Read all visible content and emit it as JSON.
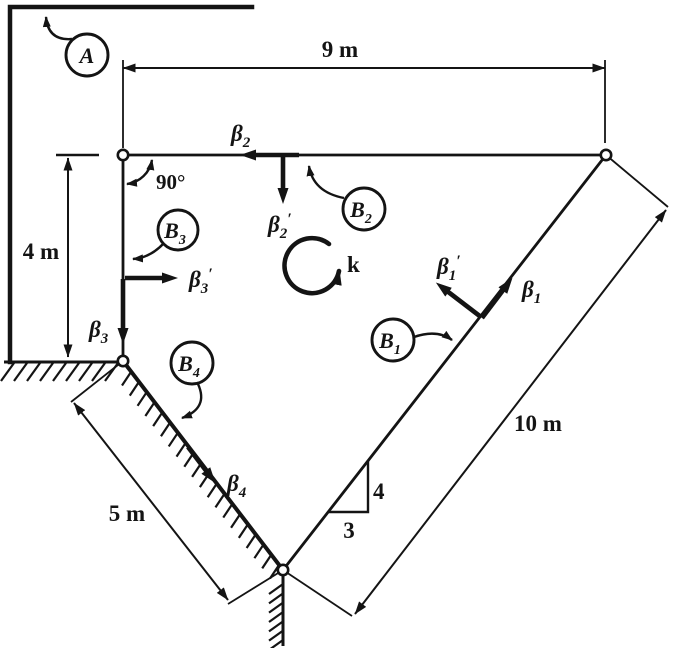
{
  "diagram": {
    "title": "rigid-body-unit-vector-figure",
    "ink": "#141414",
    "background": "#ffffff",
    "dims": {
      "top": "9 m",
      "left": "4 m",
      "incline_left": "5 m",
      "incline_right": "10 m"
    },
    "angle": "90°",
    "slope_triangle": {
      "rise": "4",
      "run": "3"
    },
    "spin": {
      "label": "k"
    },
    "vectors": {
      "beta2": {
        "base": "β",
        "sub": "2",
        "prime": ""
      },
      "beta2p": {
        "base": "β",
        "sub": "2",
        "prime": "′"
      },
      "beta3": {
        "base": "β",
        "sub": "3",
        "prime": ""
      },
      "beta3p": {
        "base": "β",
        "sub": "3",
        "prime": "′"
      },
      "beta1": {
        "base": "β",
        "sub": "1",
        "prime": ""
      },
      "beta1p": {
        "base": "β",
        "sub": "1",
        "prime": "′"
      },
      "beta4": {
        "base": "β",
        "sub": "4",
        "prime": ""
      }
    },
    "balloons": {
      "A": {
        "base": "A",
        "sub": ""
      },
      "B1": {
        "base": "B",
        "sub": "1"
      },
      "B2": {
        "base": "B",
        "sub": "2"
      },
      "B3": {
        "base": "B",
        "sub": "3"
      },
      "B4": {
        "base": "B",
        "sub": "4"
      }
    }
  }
}
